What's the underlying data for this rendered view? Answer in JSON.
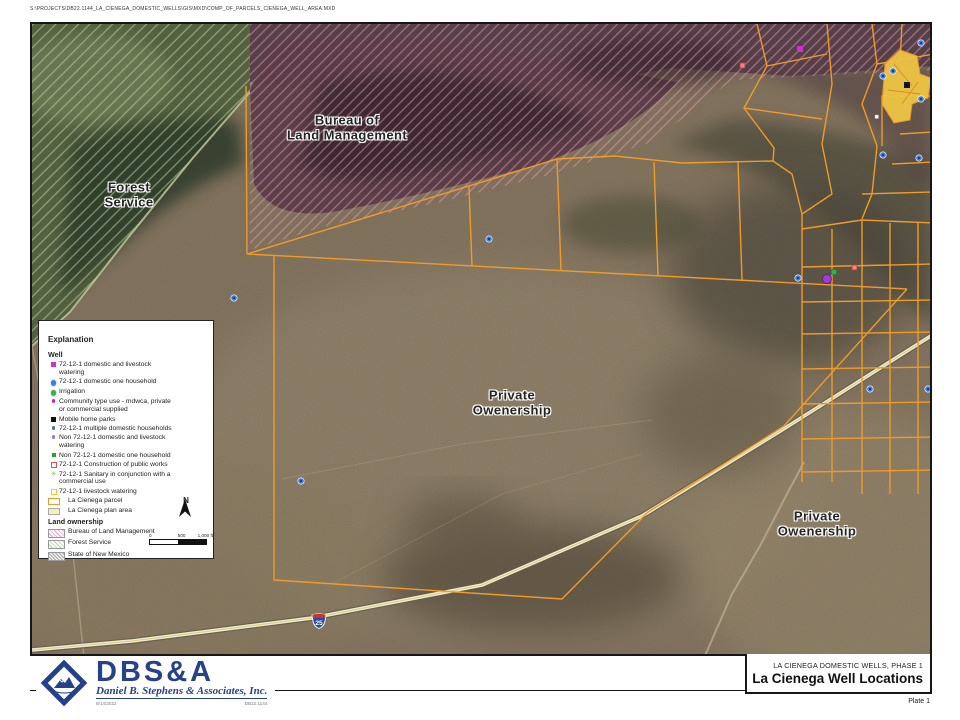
{
  "page": {
    "file_path": "S:\\PROJECTS\\DB22.1144_LA_CIENEGA_DOMESTIC_WELLS\\GIS\\MXD\\COMP_OF_PARCELS_CIENEGA_WELL_AREA.MXD"
  },
  "map": {
    "labels": {
      "forest_service": {
        "line1": "Forest",
        "line2": "Service"
      },
      "blm": {
        "line1": "Bureau of",
        "line2": "Land Management"
      },
      "private_center": {
        "line1": "Private",
        "line2": "Owenership"
      },
      "private_right": {
        "line1": "Private",
        "line2": "Owenership"
      }
    },
    "highway_shield": {
      "number": "25"
    },
    "colors": {
      "parcel_line": "#ef9b28",
      "plan_area_fill": "#eec544",
      "road_fill": "#efe9cd",
      "blm_hatch": "#f49ac1",
      "forest_hatch": "#b5e09a"
    }
  },
  "legend": {
    "title": "Explanation",
    "well_header": "Well",
    "well_items": [
      {
        "label": "72-12-1 domestic and livestock watering",
        "shape": "square",
        "color": "#cf2ed8"
      },
      {
        "label": "72-12-1 domestic one household",
        "shape": "circle",
        "color": "#3f7fe0"
      },
      {
        "label": "Irrigation",
        "shape": "circle",
        "color": "#3cb04d"
      },
      {
        "label": "Community type use - mdwca, private or commercial supplied",
        "shape": "dot",
        "color": "#c622c6"
      },
      {
        "label": "Mobile home parks",
        "shape": "square",
        "color": "#111111"
      },
      {
        "label": "72-12-1 multiple domestic households",
        "shape": "dot",
        "color": "#3f6fd6"
      },
      {
        "label": "Non 72-12-1 domestic and livestock watering",
        "shape": "dot",
        "color": "#a86fd8"
      },
      {
        "label": "Non 72-12-1 domestic one household",
        "shape": "square",
        "color": "#2ca02c"
      },
      {
        "label": "72-12-1 Construction of public works",
        "shape": "square-outline",
        "color": "#d85454"
      },
      {
        "label": "72-12-1 Sanitary in conjunction with a commercial use",
        "shape": "star",
        "color": "#7bc832"
      },
      {
        "label": "72-12-1 livestock watering",
        "shape": "square-outline",
        "color": "#d8d41f"
      }
    ],
    "parcel_items": [
      {
        "label": "La Cienega parcel",
        "shape": "rect-outline",
        "color": "#ef9b28"
      },
      {
        "label": "La Cienega plan area",
        "shape": "rect-fill",
        "color": "#f6efb7"
      }
    ],
    "ownership_header": "Land ownership",
    "ownership_items": [
      {
        "label": "Bureau of Land Management",
        "hatch_color": "#f4a0c6"
      },
      {
        "label": "Forest Service",
        "hatch_color": "#aeda9a"
      },
      {
        "label": "State of New Mexico",
        "hatch_color": "#a9a9a9"
      }
    ],
    "north_label": "N",
    "scale_ticks": [
      "0",
      "500",
      "1,000 ft"
    ]
  },
  "footer": {
    "logo_acronym": "DBS&A",
    "logo_company": "Daniel B. Stephens & Associates, Inc.",
    "logo_date": "9/14/2022",
    "logo_job": "DB22.1144",
    "project_line": "LA CIENEGA DOMESTIC WELLS, PHASE 1",
    "title": "La Cienega Well Locations",
    "plate": "Plate 1"
  }
}
